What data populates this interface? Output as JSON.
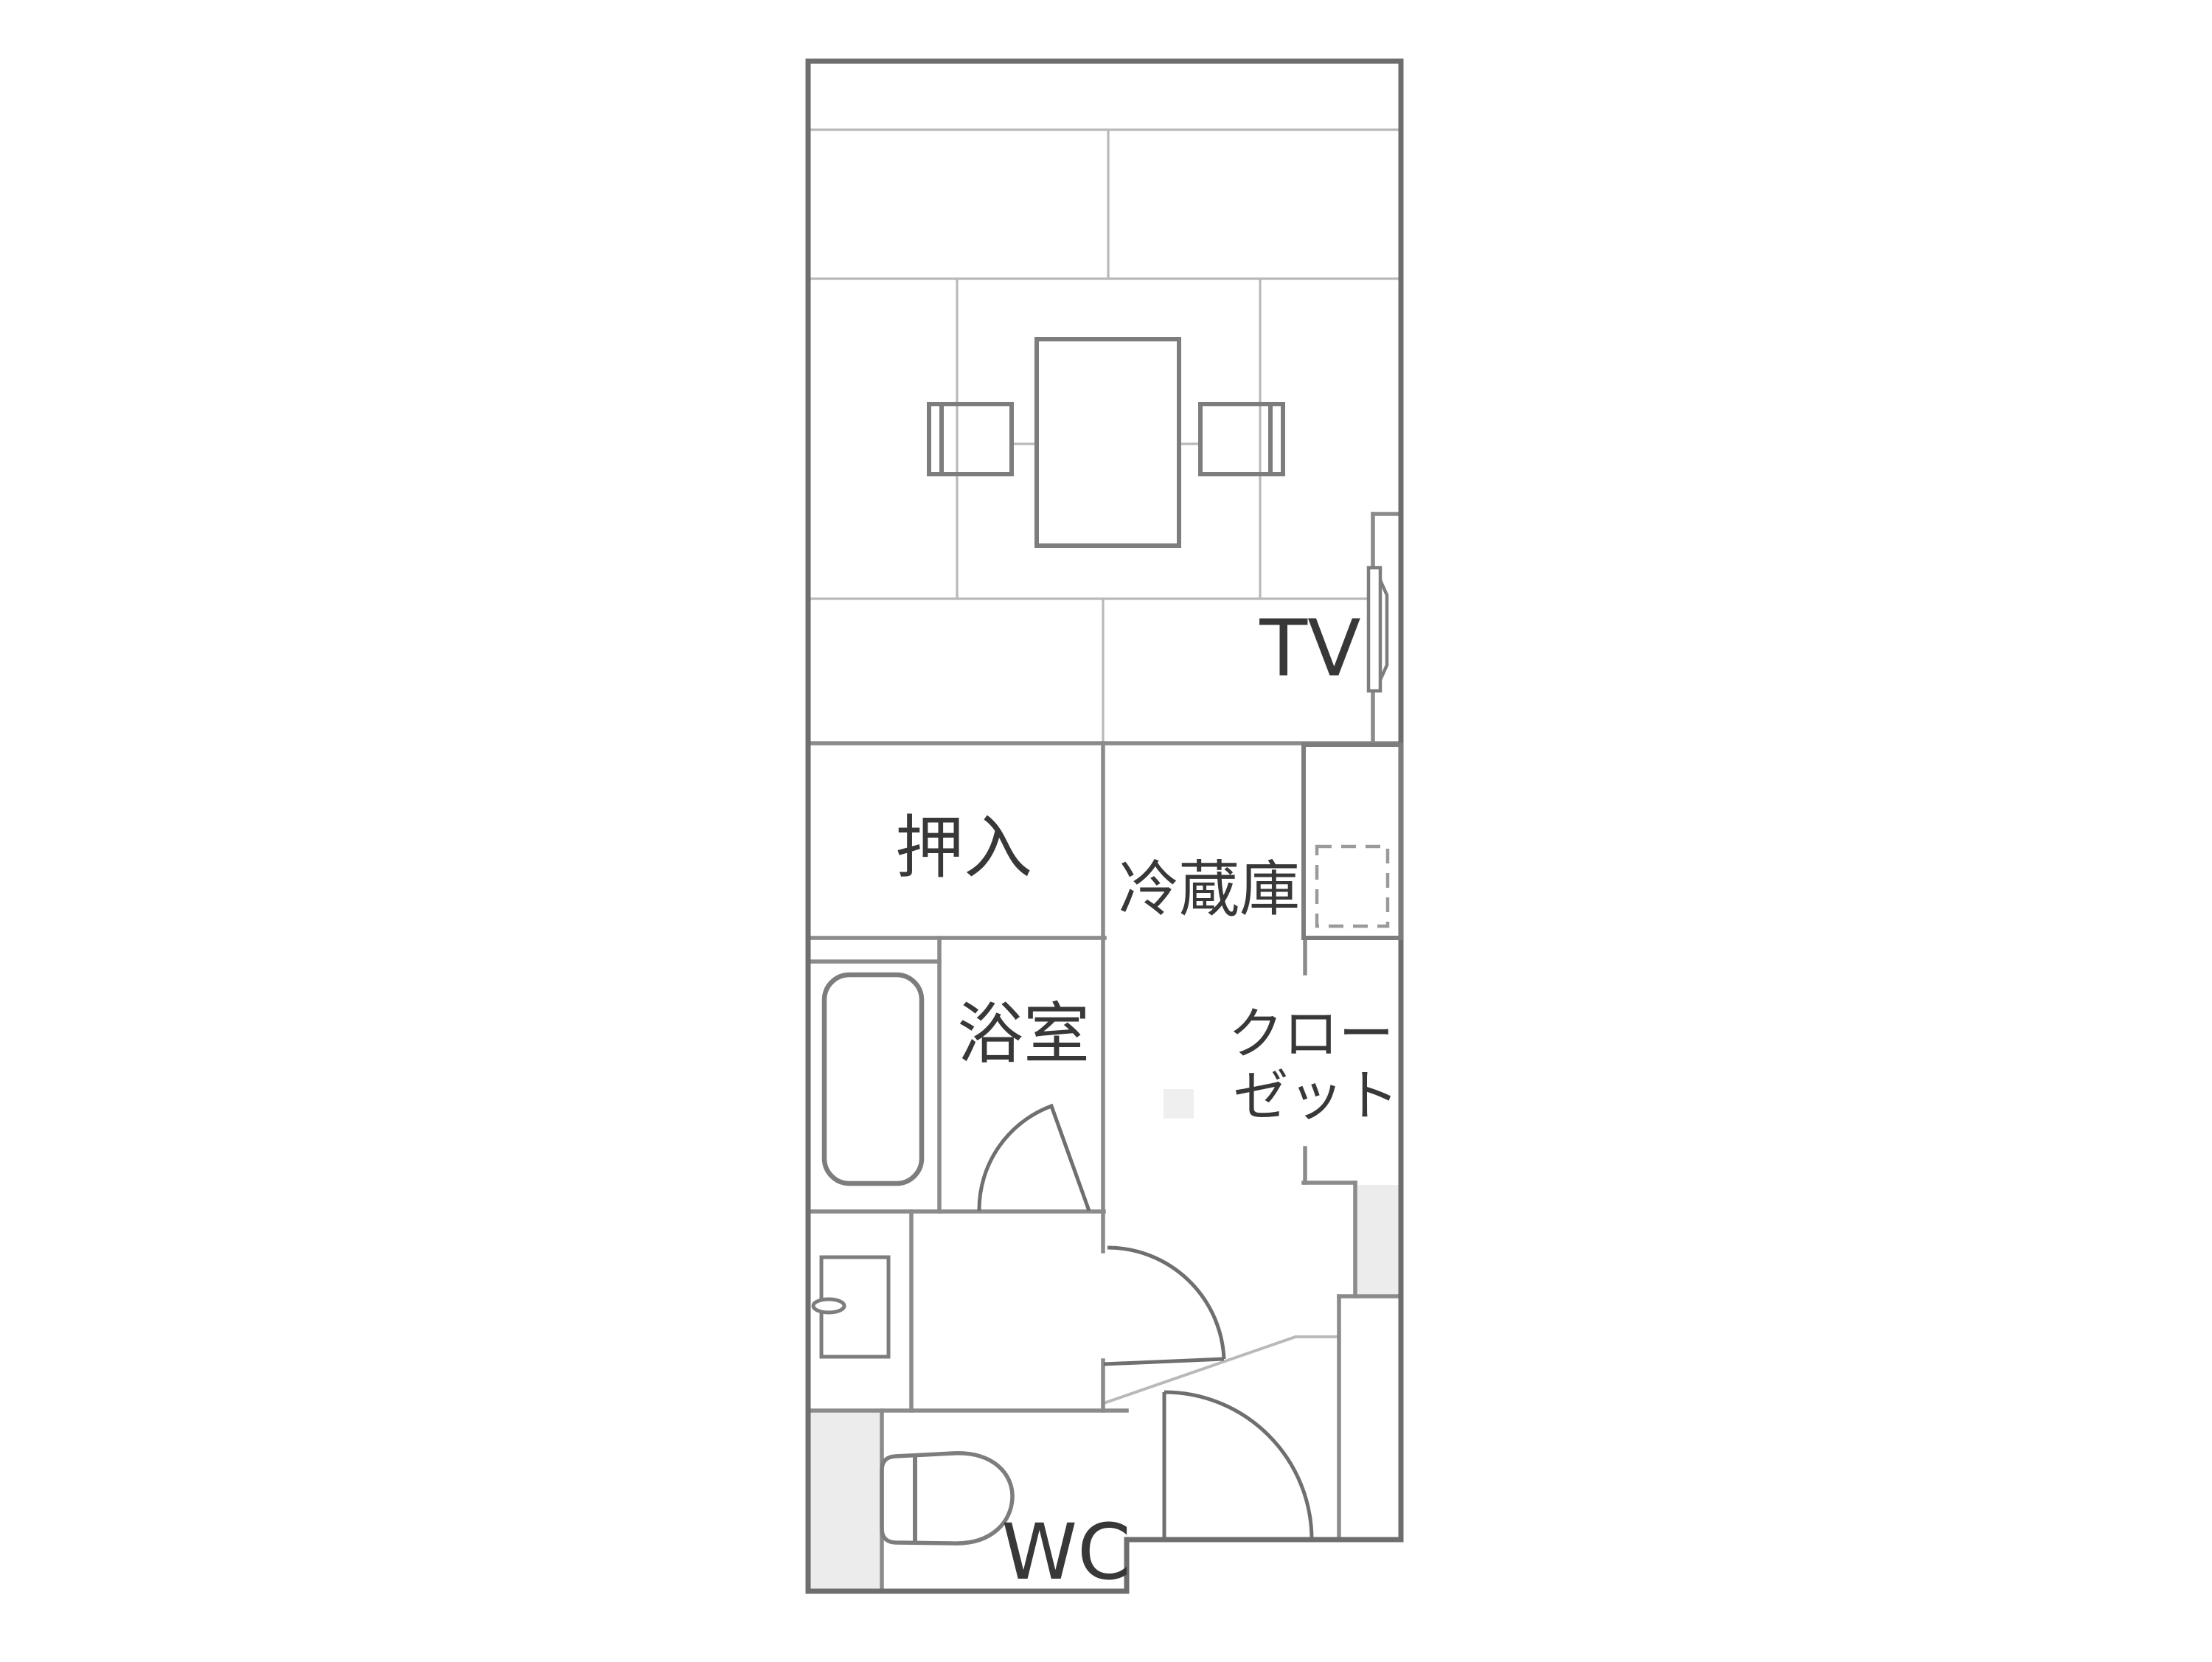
{
  "plan": {
    "title": "room-floor-plan",
    "labels": {
      "oshiire": "押入",
      "refrigerator": "冷蔵庫",
      "bathroom": "浴室",
      "closet_line1": "クロー",
      "closet_line2": "ゼット",
      "tv": "TV",
      "wc": "WC"
    },
    "colors": {
      "background": "#ffffff",
      "outer_wall": "#6e6e6e",
      "partition": "#8b8b8b",
      "light_line": "#b9b9b9",
      "furniture": "#7d7d7d",
      "door": "#6f6f6f",
      "dashed_outline": "#9a9a9a",
      "text": "#383838",
      "fill_light": "#ececec",
      "fill_faint": "#efefef",
      "fixture_fill": "#ffffff"
    }
  }
}
